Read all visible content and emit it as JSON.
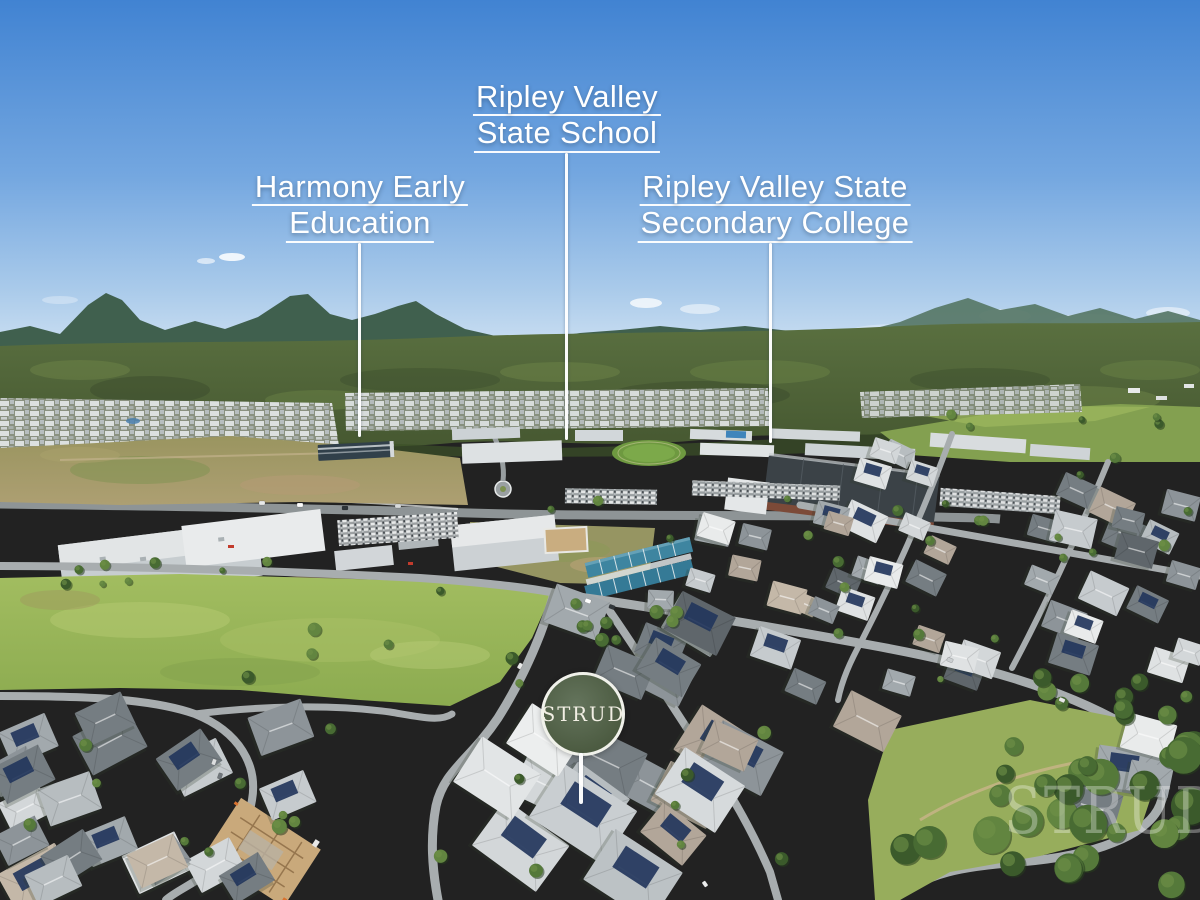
{
  "callouts": {
    "school": {
      "line1": "Ripley Valley",
      "line2": "State School"
    },
    "harmony": {
      "line1": "Harmony Early",
      "line2": "Education"
    },
    "college": {
      "line1": "Ripley Valley State",
      "line2": "Secondary College"
    }
  },
  "badge": {
    "text": "STRUD"
  },
  "watermark": {
    "text": "STRUD"
  },
  "colors": {
    "badge_green": "#52634b",
    "callout_text": "#ffffff",
    "pointer_line": "#ffffff",
    "sky_top": "#4183d2",
    "sky_horizon": "#cde0f2"
  }
}
